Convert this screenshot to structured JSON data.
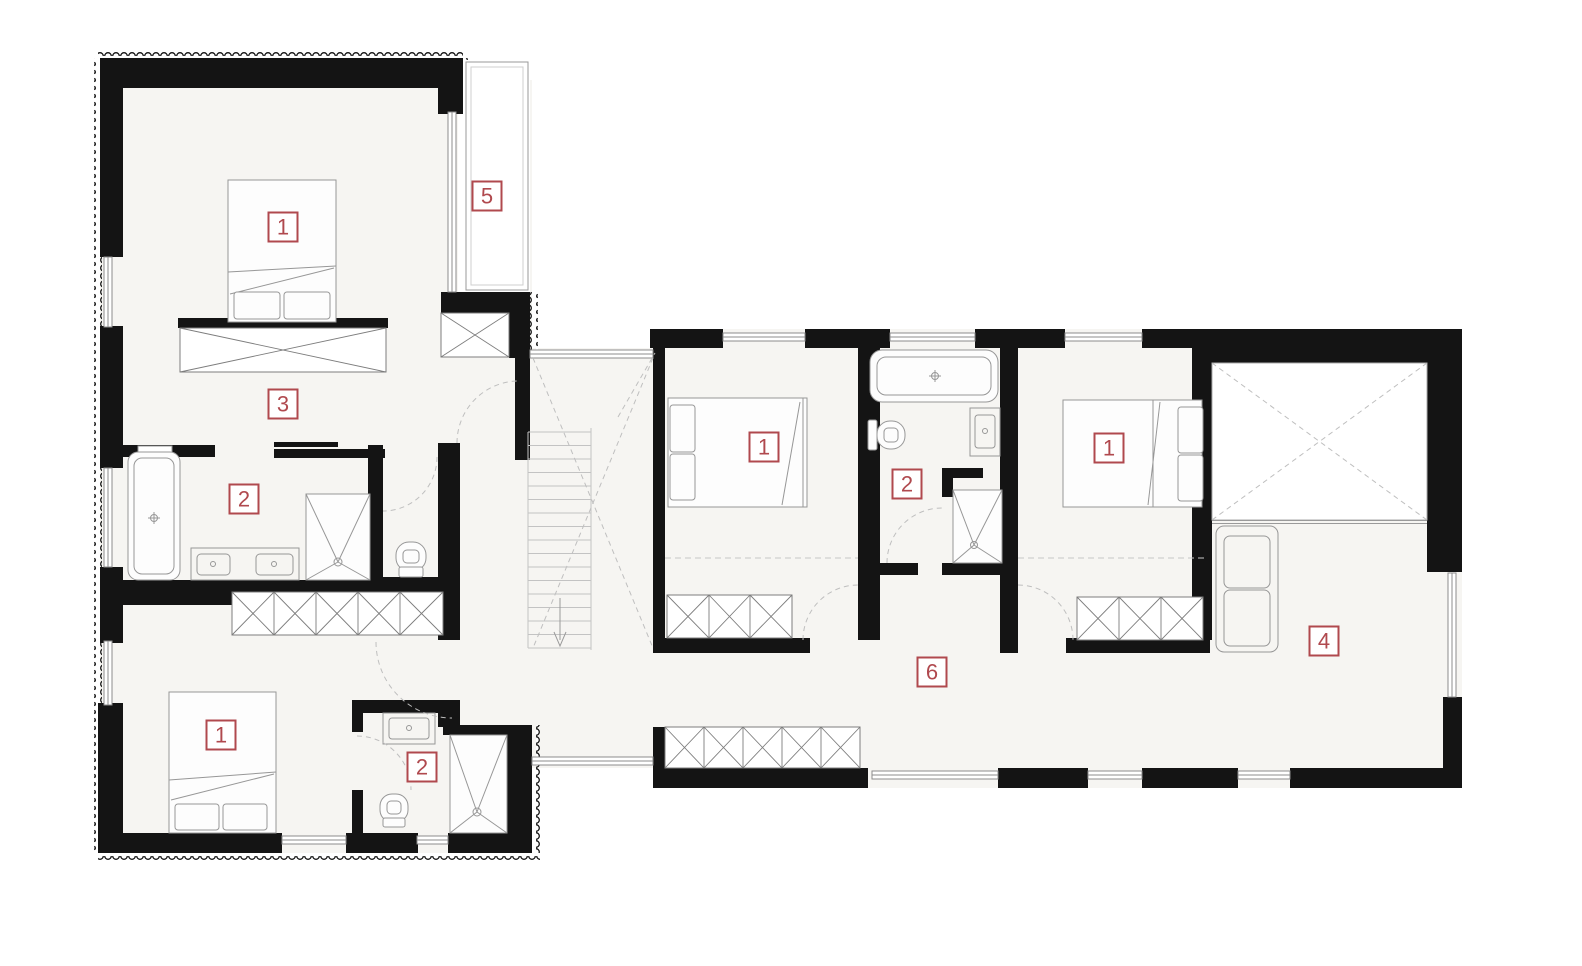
{
  "plan": {
    "title": "floor-plan",
    "canvas": {
      "width": 1582,
      "height": 966
    },
    "colors": {
      "background": "#ffffff",
      "floor": "#f6f5f2",
      "wall": "#141414",
      "accent": "#b0494e",
      "furniture_stroke": "#979797"
    },
    "room_labels": [
      {
        "number": "1",
        "room": "bedroom-top-left",
        "x": 283,
        "y": 227
      },
      {
        "number": "5",
        "room": "balcony",
        "x": 487,
        "y": 196
      },
      {
        "number": "3",
        "room": "dressing-room",
        "x": 283,
        "y": 404
      },
      {
        "number": "2",
        "room": "bathroom-left",
        "x": 244,
        "y": 499
      },
      {
        "number": "1",
        "room": "bedroom-bottom-left",
        "x": 221,
        "y": 735
      },
      {
        "number": "2",
        "room": "wc-bottom-left",
        "x": 422,
        "y": 767
      },
      {
        "number": "1",
        "room": "bedroom-center",
        "x": 764,
        "y": 447
      },
      {
        "number": "2",
        "room": "bathroom-center",
        "x": 907,
        "y": 484
      },
      {
        "number": "1",
        "room": "bedroom-right",
        "x": 1109,
        "y": 448
      },
      {
        "number": "4",
        "room": "room-four",
        "x": 1324,
        "y": 641
      },
      {
        "number": "6",
        "room": "hallway",
        "x": 932,
        "y": 672
      }
    ]
  }
}
